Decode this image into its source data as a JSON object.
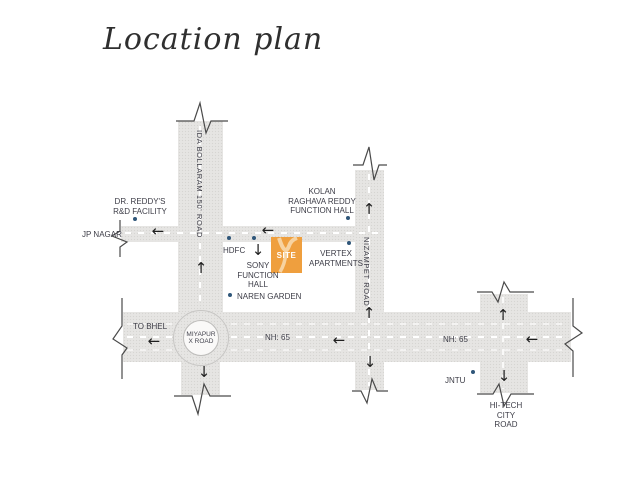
{
  "title": "Location plan",
  "colors": {
    "road_fill": "#e6e5e3",
    "site_orange": "#ef9f3e",
    "marker_blue": "#2f5679",
    "label_text": "#3d3d47"
  },
  "icons": {
    "arrow_left": "←",
    "arrow_up": "↑",
    "arrow_down": "↓"
  },
  "site": {
    "label": "SITE"
  },
  "roads": {
    "ida_bollaram": "IDA BOLLARAM  150' ROAD",
    "nizampet": "NIZAMPET ROAD",
    "nh65_west": "NH: 65",
    "nh65_east": "NH: 65",
    "hitech": "HI-TECH\nCITY\nROAD",
    "miyapur_circle": "MIYAPUR\nX ROAD"
  },
  "landmarks": {
    "dr_reddys": "DR. REDDY'S\nR&D FACILITY",
    "jp_nagar": "JP NAGAR",
    "kolan": "KOLAN\nRAGHAVA REDDY\nFUNCTION HALL",
    "hdfc": "HDFC",
    "vertex": "VERTEX\nAPARTMENTS",
    "sony": "SONY\nFUNCTION\nHALL",
    "naren": "NAREN GARDEN",
    "to_bhel": "TO BHEL",
    "jntu": "JNTU"
  }
}
